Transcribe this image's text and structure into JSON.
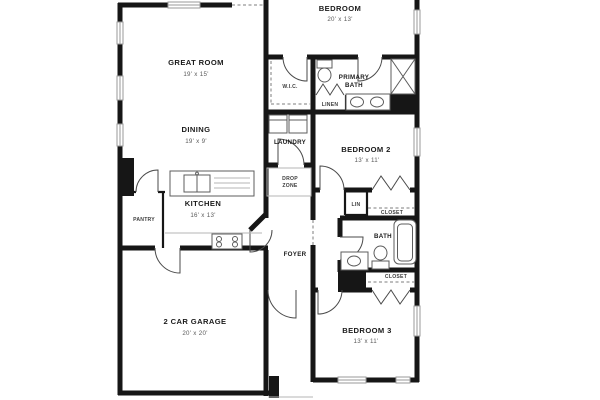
{
  "floorplan": {
    "colors": {
      "wall": "#161616",
      "fixture": "#5c5c5c",
      "door": "#4a4a4a",
      "dash": "#7d7d7d",
      "window": "#9a9a9a",
      "label": "#1b1b1b",
      "dim": "#5a5a5a",
      "small": "#3d3d3d",
      "light": "#b5b5b5",
      "css": "--wall:#161616;--fixture:#5c5c5c;--door:#4a4a4a;--dash:#7d7d7d;--window:#9a9a9a;--label:#1b1b1b;--dim:#5a5a5a;--small:#3d3d3d;--light:#b5b5b5"
    },
    "rooms": {
      "bedroom": {
        "name": "BEDROOM",
        "dims": "20' x 13'"
      },
      "great_room": {
        "name": "GREAT ROOM",
        "dims": "19' x 15'"
      },
      "dining": {
        "name": "DINING",
        "dims": "19' x 9'"
      },
      "kitchen": {
        "name": "KITCHEN",
        "dims": "16' x 13'"
      },
      "pantry": {
        "name": "PANTRY"
      },
      "garage": {
        "name": "2 CAR GARAGE",
        "dims": "20' x 20'"
      },
      "wic": {
        "name": "W.I.C."
      },
      "primary_bath": {
        "line1": "PRIMARY",
        "line2": "BATH"
      },
      "linen": {
        "name": "LINEN"
      },
      "laundry": {
        "name": "LAUNDRY"
      },
      "drop_zone": {
        "line1": "DROP",
        "line2": "ZONE"
      },
      "bedroom2": {
        "name": "BEDROOM 2",
        "dims": "13' x 11'"
      },
      "lin": {
        "name": "LIN"
      },
      "closet_bedroom2": {
        "name": "CLOSET"
      },
      "bath": {
        "name": "BATH"
      },
      "closet_bedroom3": {
        "name": "CLOSET"
      },
      "bedroom3": {
        "name": "BEDROOM 3",
        "dims": "13' x 11'"
      },
      "foyer": {
        "name": "FOYER"
      }
    }
  }
}
